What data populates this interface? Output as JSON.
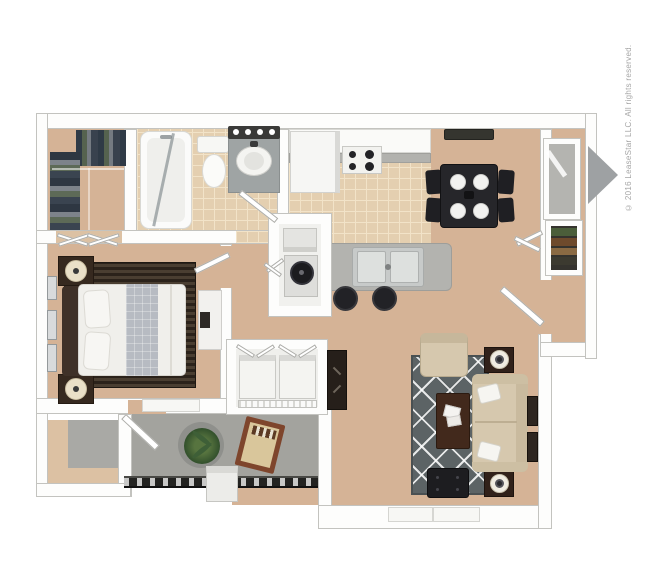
{
  "page": {
    "kind": "3d-floor-plan-top-view",
    "unit": "one-bedroom, one-bath apartment",
    "text_labels_visible": false
  },
  "copyright": "© 2016 LeaseStar LLC. All rights reserved.",
  "colors": {
    "background": "#ffffff",
    "wall": "#fdfdfc",
    "wall_edge": "#c3c3bf",
    "floor_tan": "#d5b396",
    "floor_tan_light": "#dcc1a3",
    "tile": "#e4cfb0",
    "tile_grout": "#f2e3c8",
    "patio_concrete": "#a3a39e",
    "storage_floor": "#a9a9a5",
    "dark_furniture": "#222226",
    "wood_dark": "#43301f",
    "wood_medium": "#7b4a2f",
    "sofa_beige": "#d6c8ae",
    "rug_gray": "#5c6365",
    "rug_bedroom_dark": "#342b21",
    "bedding_white": "#f0efeb",
    "duvet_gray": "#b7bbc2",
    "stainless": "#c7cac9",
    "counter_gray": "#b2b2ae",
    "plant_green": "#46673c",
    "lamp_cream": "#eae0c8",
    "door_gray": "#9ea1a3",
    "copyright_text": "#a6a6a6"
  },
  "rooms": [
    {
      "id": "walk-in-closet",
      "furniture": [
        "hanging-clothes",
        "folded-clothes",
        "closet-rod"
      ]
    },
    {
      "id": "bathroom",
      "furniture": [
        "bathtub",
        "shower-glass-door",
        "toilet",
        "vanity-sink",
        "vanity-light-bar",
        "bathroom-door"
      ]
    },
    {
      "id": "bedroom",
      "furniture": [
        "queen-bed",
        "headboard",
        "pillows",
        "striped-area-rug",
        "nightstand-top",
        "nightstand-bottom",
        "table-lamp-top",
        "table-lamp-bottom",
        "wall-art-frames",
        "dresser",
        "window",
        "bifold-closet-doors",
        "bedroom-door"
      ]
    },
    {
      "id": "kitchen",
      "furniture": [
        "refrigerator",
        "cabinet-run",
        "countertop",
        "range-4-burners",
        "breakfast-bar",
        "double-sink",
        "bar-stool-left",
        "bar-stool-right"
      ]
    },
    {
      "id": "dining-area",
      "furniture": [
        "square-dining-table",
        "dining-chairs-4",
        "place-settings-4",
        "ceiling-light"
      ]
    },
    {
      "id": "utility-closet",
      "furniture": [
        "water-heater",
        "shelf-unit",
        "utility-door"
      ]
    },
    {
      "id": "laundry-closet",
      "furniture": [
        "washer",
        "dryer",
        "wire-shelf",
        "bifold-doors"
      ]
    },
    {
      "id": "hallway",
      "furniture": [
        "media-console"
      ]
    },
    {
      "id": "entry",
      "furniture": [
        "front-door-open",
        "entry-side-window",
        "pantry-shelves",
        "closet-bifold-doors",
        "interior-door"
      ]
    },
    {
      "id": "living-room",
      "furniture": [
        "sofa",
        "throw-pillows",
        "armchair",
        "coffee-table",
        "magazines",
        "ottoman",
        "diamond-rug",
        "end-table-top",
        "end-table-bottom",
        "table-lamp-top",
        "table-lamp-bottom",
        "wall-art-frames",
        "window"
      ]
    },
    {
      "id": "patio",
      "furniture": [
        "potted-plant",
        "chaise-lounge",
        "railing",
        "patio-door",
        "utility-box"
      ]
    },
    {
      "id": "storage-closet",
      "furniture": []
    }
  ]
}
